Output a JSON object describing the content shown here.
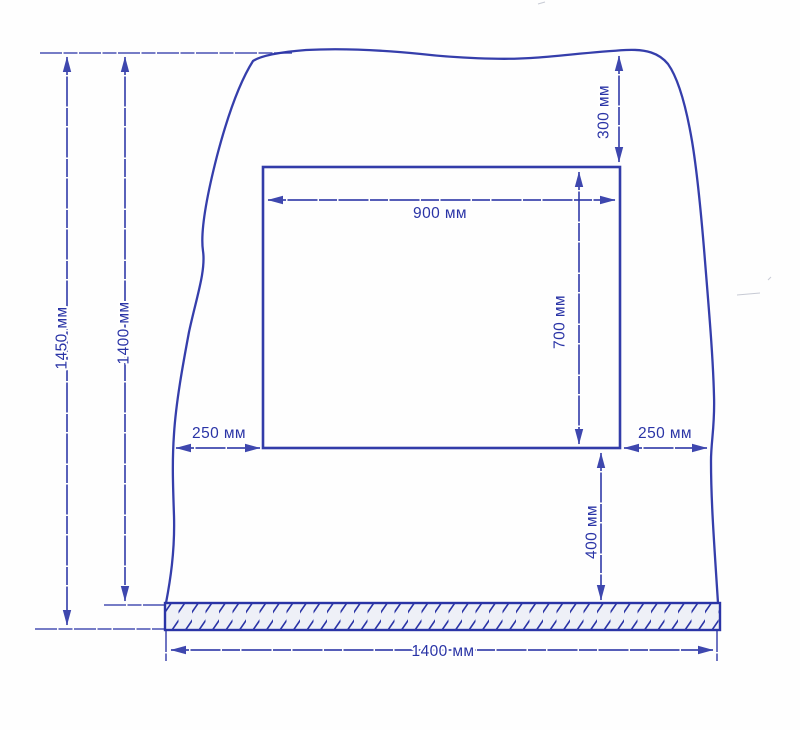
{
  "drawing": {
    "type": "wall opening installation dimension drawing",
    "unit": "мм",
    "ink_color": "#2a34a6",
    "paper_color": "#fefefe",
    "floor_hatch": "diagonal-lines",
    "labels": {
      "total_height": "1450 мм",
      "height_above_floor": "1400 мм",
      "top_clearance": "300 мм",
      "opening_width": "900 мм",
      "opening_height": "700 мм",
      "left_clearance": "250 мм",
      "right_clearance": "250 мм",
      "bottom_clearance": "400 мм",
      "wall_width": "1400 мм"
    },
    "dimensions_mm": {
      "total_height": 1450,
      "height_above_floor": 1400,
      "top_clearance": 300,
      "opening_width": 900,
      "opening_height": 700,
      "left_clearance": 250,
      "right_clearance": 250,
      "bottom_clearance": 400,
      "wall_width": 1400
    }
  }
}
